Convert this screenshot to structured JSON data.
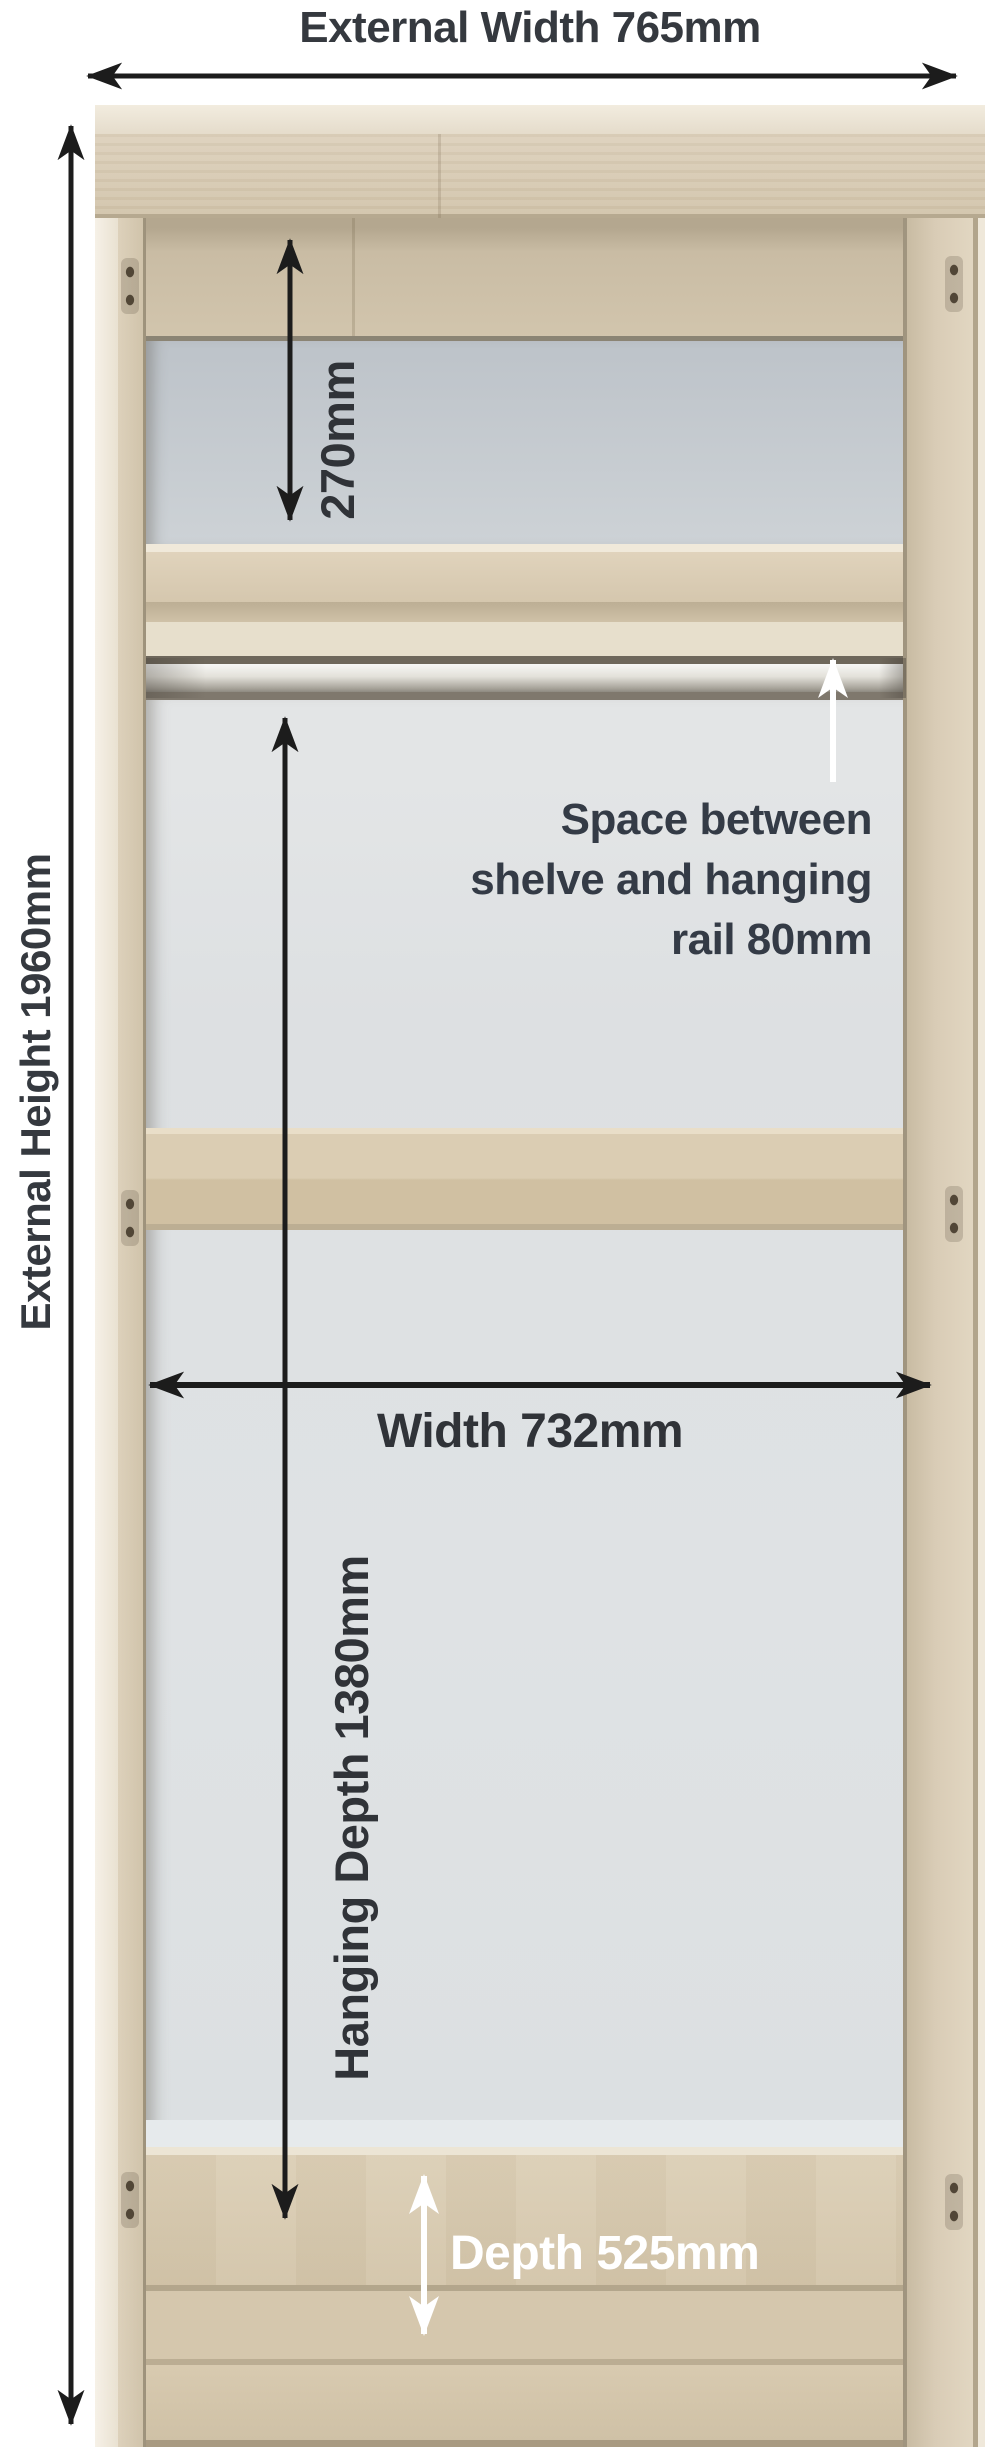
{
  "labels": {
    "external_width": "External Width 765mm",
    "external_height": "External Height 1960mm",
    "top_shelf_space": "270mm",
    "shelf_rail_space": [
      "Space between",
      "shelve and hanging",
      "rail 80mm"
    ],
    "internal_width": "Width 732mm",
    "hanging_depth": "Hanging Depth 1380mm",
    "internal_depth": "Depth 525mm"
  },
  "colors": {
    "dimension_text_dark": "#35393f",
    "dimension_text_white": "#ffffff",
    "arrow_black": "#1c1c1c",
    "arrow_white": "#ffffff",
    "wood_frame": "#d7cab3",
    "wood_edge_light": "#efe8da",
    "back_panel_top_gray": "#c4cad0",
    "back_panel_main": "#dfe2e4",
    "shelf_wood": "#d9cbb2",
    "hanging_rail_chrome": "#d9d7d0",
    "floor_wood": "#d6c8ae"
  }
}
